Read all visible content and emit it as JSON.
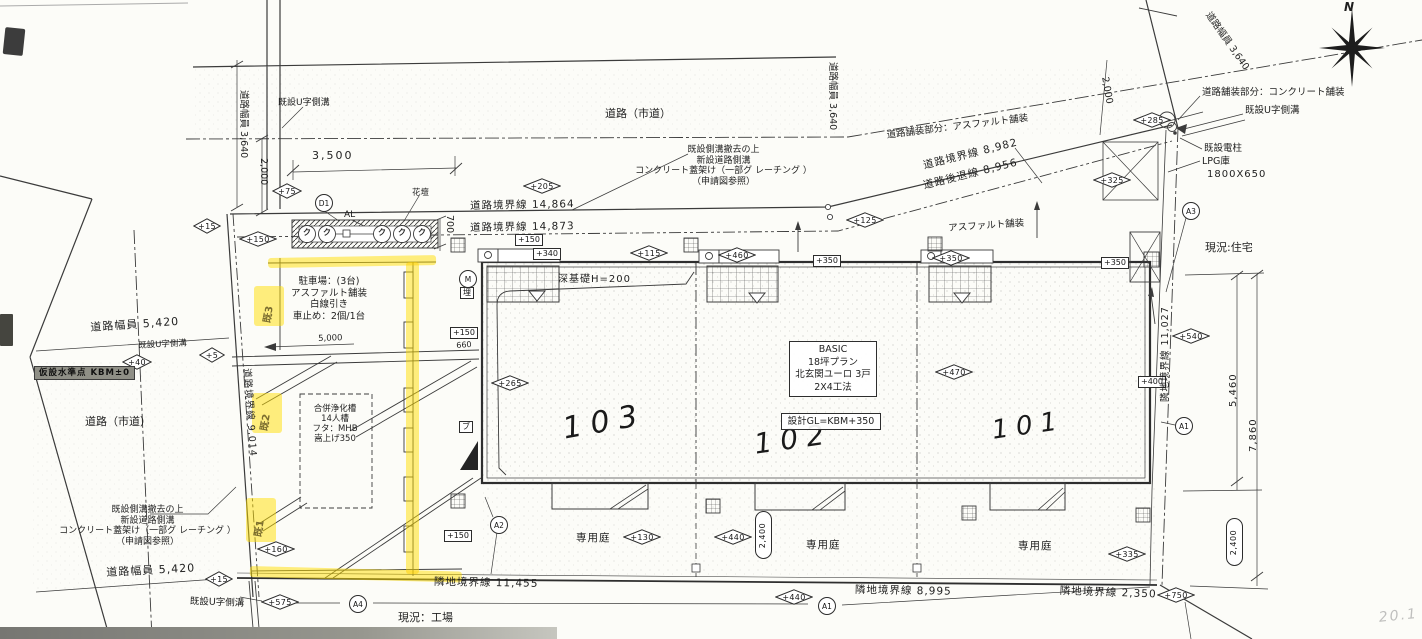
{
  "ink_color": "#3b3b3b",
  "highlight_color": "#ffdd00",
  "compass": {
    "label": "N"
  },
  "labels": [
    {
      "n": "road-city-top-label",
      "t": "道路（市道）",
      "x": 605,
      "y": 108,
      "fs": 11
    },
    {
      "n": "road-city-left-label",
      "t": "道路（市道）",
      "x": 85,
      "y": 416,
      "fs": 11
    },
    {
      "n": "gutter-note-topleft",
      "t": "既設U字側溝",
      "x": 278,
      "y": 98,
      "fs": 9
    },
    {
      "n": "road-width-left",
      "t": "道路幅員 3,640",
      "x": 249,
      "y": 90,
      "fs": 9.5,
      "rot": 90
    },
    {
      "n": "dim-2000-left",
      "t": "2,000",
      "x": 269,
      "y": 158,
      "fs": 9.5,
      "rot": 90
    },
    {
      "n": "dim-3500",
      "t": "3,500",
      "x": 312,
      "y": 150,
      "fs": 11,
      "ls": 2
    },
    {
      "n": "road-boundary-14864",
      "t": "道路境界線 14,864",
      "x": 470,
      "y": 200,
      "fs": 10.5,
      "rot": -1,
      "ls": 1
    },
    {
      "n": "road-boundary-14873",
      "t": "道路境界線 14,873",
      "x": 470,
      "y": 222,
      "fs": 10.5,
      "rot": -1,
      "ls": 1
    },
    {
      "n": "note-sidewalk-top",
      "t": "既設側溝撤去の上\n新設道路側溝\nコンクリート蓋架け（一部グ レーチング ）\n（申請図参照）",
      "x": 626,
      "y": 145,
      "fs": 9,
      "w": 195,
      "ta": "center",
      "lh": 1.18
    },
    {
      "n": "note-pave-asphalt",
      "t": "道路舗装部分：アスファルト舗装",
      "x": 886,
      "y": 130,
      "fs": 9.5,
      "rot": -7
    },
    {
      "n": "road-boundary-8982",
      "t": "道路境界線 8,982",
      "x": 922,
      "y": 160,
      "fs": 10.5,
      "rot": -14,
      "ls": 1
    },
    {
      "n": "road-setback-8956",
      "t": "道路後退線 8,956",
      "x": 922,
      "y": 180,
      "fs": 10.5,
      "rot": -14,
      "ls": 1
    },
    {
      "n": "asphalt-pave-label",
      "t": "アスファルト舗装",
      "x": 948,
      "y": 223,
      "fs": 9.5,
      "rot": -4
    },
    {
      "n": "road-width-mid",
      "t": "道路幅員 3,640",
      "x": 838,
      "y": 62,
      "fs": 9.5,
      "rot": 90
    },
    {
      "n": "dim-2000-right",
      "t": "2,000",
      "x": 1110,
      "y": 76,
      "fs": 9.5,
      "rot": 80
    },
    {
      "n": "road-width-right",
      "t": "道路幅員 3,640",
      "x": 1212,
      "y": 10,
      "fs": 9.5,
      "rot": 55
    },
    {
      "n": "note-pave-concrete",
      "t": "道路舗装部分：コンクリート舗装",
      "x": 1202,
      "y": 87,
      "fs": 9.5
    },
    {
      "n": "gutter-note-topright",
      "t": "既設U字側溝",
      "x": 1245,
      "y": 105,
      "fs": 9.5
    },
    {
      "n": "pole-note",
      "t": "既設電柱",
      "x": 1204,
      "y": 143,
      "fs": 9.5
    },
    {
      "n": "lpg-note",
      "t": "LPG庫",
      "x": 1202,
      "y": 156,
      "fs": 9.5
    },
    {
      "n": "lpg-size",
      "t": "1800X650",
      "x": 1207,
      "y": 169,
      "fs": 10,
      "ls": 1
    },
    {
      "n": "existing-house-label",
      "t": "現況:住宅",
      "x": 1205,
      "y": 242,
      "fs": 11
    },
    {
      "n": "flowerbed-label",
      "t": "花壇",
      "x": 412,
      "y": 188,
      "fs": 8.5
    },
    {
      "n": "al-label",
      "t": "AL",
      "x": 344,
      "y": 210,
      "fs": 9
    },
    {
      "n": "dim-700",
      "t": "700",
      "x": 455,
      "y": 215,
      "fs": 9.5,
      "rot": 90
    },
    {
      "n": "parking-note",
      "t": "駐車場：(3台)\nアスファルト舗装\n白線引き\n車止め：2個/1台",
      "x": 285,
      "y": 276,
      "fs": 9.5,
      "w": 88,
      "ta": "center",
      "lh": 1.22
    },
    {
      "n": "dim-5000",
      "t": "5,000",
      "x": 318,
      "y": 334,
      "fs": 8.5,
      "rot": -2
    },
    {
      "n": "septic-note",
      "t": "合併浄化槽\n14人槽\nフタ：MHB\n嵩上げ350",
      "x": 303,
      "y": 404,
      "fs": 8.5,
      "w": 64,
      "ta": "center",
      "lh": 1.18
    },
    {
      "n": "kbm-benchmark",
      "t": "仮設水準点 KBM±0",
      "x": 34,
      "y": 366,
      "fs": 8.5,
      "cls": "kbm"
    },
    {
      "n": "road-boundary-9014",
      "t": "道路境界線 9,014",
      "x": 252,
      "y": 368,
      "fs": 9.5,
      "rot": 86,
      "ls": 1
    },
    {
      "n": "road-width-5420-top",
      "t": "道路幅員 5,420",
      "x": 90,
      "y": 322,
      "fs": 11,
      "rot": -4,
      "ls": 1
    },
    {
      "n": "gutter-note-left",
      "t": "既設U字側溝",
      "x": 138,
      "y": 341,
      "fs": 8.5,
      "rot": -3
    },
    {
      "n": "note-sidewalk-left",
      "t": "既設側溝撤去の上\n新設道路側溝\nコンクリート蓋架け（一部グ レーチング ）\n（申請図参照）",
      "x": 55,
      "y": 505,
      "fs": 9,
      "w": 185,
      "ta": "center",
      "lh": 1.18
    },
    {
      "n": "road-width-5420-bottom",
      "t": "道路幅員 5,420",
      "x": 106,
      "y": 567,
      "fs": 11,
      "rot": -3,
      "ls": 1
    },
    {
      "n": "gutter-note-bottomleft",
      "t": "既設U字側溝",
      "x": 190,
      "y": 596,
      "fs": 9.5,
      "rot": 2
    },
    {
      "n": "existing-factory-label",
      "t": "現況：工場",
      "x": 398,
      "y": 612,
      "fs": 11
    },
    {
      "n": "site-boundary-11455",
      "t": "隣地境界線 11,455",
      "x": 434,
      "y": 576,
      "fs": 10.5,
      "rot": 1,
      "ls": 1
    },
    {
      "n": "site-boundary-8995",
      "t": "隣地境界線 8,995",
      "x": 855,
      "y": 584,
      "fs": 10.5,
      "rot": 1,
      "ls": 1
    },
    {
      "n": "site-boundary-2350",
      "t": "隣地境界線 2,350",
      "x": 1060,
      "y": 585,
      "fs": 10.5,
      "rot": 2,
      "ls": 1
    },
    {
      "n": "site-boundary-11027",
      "t": "隣地境界線 11,027",
      "x": 1160,
      "y": 402,
      "fs": 9.5,
      "rot": -90,
      "ls": 1
    },
    {
      "n": "dim-5460",
      "t": "5,460",
      "x": 1228,
      "y": 407,
      "fs": 10,
      "rot": -90,
      "ls": 1
    },
    {
      "n": "dim-7860",
      "t": "7,860",
      "x": 1248,
      "y": 452,
      "fs": 10,
      "rot": -90,
      "ls": 1
    },
    {
      "n": "deep-foundation-label",
      "t": "深基礎H=200",
      "x": 558,
      "y": 274,
      "fs": 10,
      "ls": 1
    },
    {
      "n": "unit-number-103",
      "t": "103",
      "x": 560,
      "y": 412,
      "fs": 30,
      "rot": -10,
      "cls": "hand"
    },
    {
      "n": "unit-number-102",
      "t": "102",
      "x": 752,
      "y": 428,
      "fs": 28,
      "rot": -8,
      "cls": "hand"
    },
    {
      "n": "unit-number-101",
      "t": "101",
      "x": 990,
      "y": 416,
      "fs": 26,
      "rot": -8,
      "cls": "hand"
    },
    {
      "n": "private-garden-103",
      "t": "専用庭",
      "x": 576,
      "y": 532,
      "fs": 10.5,
      "ls": 1
    },
    {
      "n": "private-garden-102",
      "t": "専用庭",
      "x": 806,
      "y": 539,
      "fs": 10.5,
      "ls": 1
    },
    {
      "n": "private-garden-101",
      "t": "専用庭",
      "x": 1018,
      "y": 540,
      "fs": 10.5,
      "ls": 1
    },
    {
      "n": "dim-660",
      "t": "660",
      "x": 456,
      "y": 341,
      "fs": 8,
      "rot": -4
    },
    {
      "n": "compass-north-label",
      "t": "N",
      "x": 1344,
      "y": 0,
      "fs": 12,
      "cls": "hand2"
    },
    {
      "n": "pencil-mark",
      "t": "20.1",
      "x": 1378,
      "y": 610,
      "fs": 14,
      "rot": -6,
      "cls": "pencil"
    },
    {
      "n": "highlight-mark-3",
      "t": "既3",
      "x": 262,
      "y": 322,
      "fs": 10,
      "rot": -80,
      "cls": "handmark"
    },
    {
      "n": "highlight-mark-2",
      "t": "既2",
      "x": 259,
      "y": 430,
      "fs": 10,
      "rot": -80,
      "cls": "handmark"
    },
    {
      "n": "highlight-mark-1",
      "t": "既1",
      "x": 253,
      "y": 536,
      "fs": 10,
      "rot": -80,
      "cls": "handmark"
    },
    {
      "n": "plant-symbol",
      "t": "ク",
      "x": 303,
      "y": 228,
      "fs": 8,
      "cls": "plant"
    },
    {
      "n": "plant-symbol",
      "t": "ク",
      "x": 323,
      "y": 228,
      "fs": 8,
      "cls": "plant"
    },
    {
      "n": "plant-symbol",
      "t": "ク",
      "x": 378,
      "y": 228,
      "fs": 8,
      "cls": "plant"
    },
    {
      "n": "plant-symbol",
      "t": "ク",
      "x": 398,
      "y": 228,
      "fs": 8,
      "cls": "plant"
    },
    {
      "n": "plant-symbol",
      "t": "ク",
      "x": 418,
      "y": 228,
      "fs": 8,
      "cls": "plant"
    },
    {
      "n": "building-spec-box",
      "t": "BASIC\n18坪プラン\n北玄関ユーロ 3戸\n2X4工法",
      "x": 789,
      "y": 341,
      "fs": 9.5,
      "w": 80,
      "ta": "center",
      "lh": 1.32,
      "cls": "boxed"
    },
    {
      "n": "design-gl-box",
      "t": "設計GL=KBM+350",
      "x": 781,
      "y": 413,
      "fs": 9.5,
      "w": 92,
      "ta": "center",
      "cls": "boxed"
    }
  ],
  "markers": [
    {
      "n": "elev-205",
      "s": "d",
      "t": "+205",
      "cx": 542,
      "cy": 186
    },
    {
      "n": "elev-75",
      "s": "d",
      "t": "+75",
      "cx": 287,
      "cy": 191,
      "w": 30
    },
    {
      "n": "elev-15-flowerbed",
      "s": "d",
      "t": "+15",
      "cx": 207,
      "cy": 226,
      "w": 28
    },
    {
      "n": "elev-150-flowerbed",
      "s": "d",
      "t": "+150",
      "cx": 258,
      "cy": 239
    },
    {
      "n": "elev-115",
      "s": "d",
      "t": "+115",
      "cx": 649,
      "cy": 253
    },
    {
      "n": "elev-460",
      "s": "d",
      "t": "+460",
      "cx": 737,
      "cy": 255
    },
    {
      "n": "elev-350-mid",
      "s": "d",
      "t": "+350",
      "cx": 951,
      "cy": 258
    },
    {
      "n": "elev-265",
      "s": "d",
      "t": "+265",
      "cx": 510,
      "cy": 383
    },
    {
      "n": "elev-470",
      "s": "d",
      "t": "+470",
      "cx": 954,
      "cy": 372
    },
    {
      "n": "elev-325",
      "s": "d",
      "t": "+325",
      "cx": 1112,
      "cy": 180
    },
    {
      "n": "elev-285",
      "s": "d",
      "t": "+285",
      "cx": 1152,
      "cy": 120
    },
    {
      "n": "elev-125",
      "s": "d",
      "t": "+125",
      "cx": 865,
      "cy": 220
    },
    {
      "n": "elev-540",
      "s": "d",
      "t": "+540",
      "cx": 1191,
      "cy": 336
    },
    {
      "n": "elev-40",
      "s": "d",
      "t": "+40",
      "cx": 137,
      "cy": 362,
      "w": 30
    },
    {
      "n": "elev-5",
      "s": "d",
      "t": "+5",
      "cx": 212,
      "cy": 355,
      "w": 26
    },
    {
      "n": "elev-160",
      "s": "d",
      "t": "+160",
      "cx": 276,
      "cy": 549
    },
    {
      "n": "elev-15-bottom",
      "s": "d",
      "t": "+15",
      "cx": 219,
      "cy": 579,
      "w": 28
    },
    {
      "n": "elev-575",
      "s": "d",
      "t": "+575",
      "cx": 280,
      "cy": 602
    },
    {
      "n": "elev-130",
      "s": "d",
      "t": "+130",
      "cx": 642,
      "cy": 537
    },
    {
      "n": "elev-440-garden",
      "s": "d",
      "t": "+440",
      "cx": 733,
      "cy": 537
    },
    {
      "n": "elev-440-bottom",
      "s": "d",
      "t": "+440",
      "cx": 794,
      "cy": 597
    },
    {
      "n": "elev-335",
      "s": "d",
      "t": "+335",
      "cx": 1127,
      "cy": 554
    },
    {
      "n": "elev-750",
      "s": "d",
      "t": "+750",
      "cx": 1176,
      "cy": 595
    },
    {
      "n": "spot-150-porch",
      "s": "b",
      "t": "+150",
      "cx": 529,
      "cy": 240
    },
    {
      "n": "spot-340-porch",
      "s": "b",
      "t": "+340",
      "cx": 547,
      "cy": 254
    },
    {
      "n": "spot-350-mid",
      "s": "b",
      "t": "+350",
      "cx": 827,
      "cy": 261
    },
    {
      "n": "spot-350-right",
      "s": "b",
      "t": "+350",
      "cx": 1115,
      "cy": 263
    },
    {
      "n": "spot-150-gate",
      "s": "b",
      "t": "+150",
      "cx": 464,
      "cy": 333
    },
    {
      "n": "spot-150-south",
      "s": "b",
      "t": "+150",
      "cx": 458,
      "cy": 536
    },
    {
      "n": "spot-400-right",
      "s": "b",
      "t": "+400",
      "cx": 1152,
      "cy": 382
    },
    {
      "n": "buried-utility-marker",
      "s": "b",
      "t": "埋",
      "cx": 467,
      "cy": 293
    },
    {
      "n": "bu-marker",
      "s": "b",
      "t": "ブ",
      "cx": 466,
      "cy": 427
    },
    {
      "n": "detail-marker-d1",
      "s": "c",
      "t": "D1",
      "cx": 323,
      "cy": 202
    },
    {
      "n": "meter-marker-m",
      "s": "c",
      "t": "M",
      "cx": 467,
      "cy": 278
    },
    {
      "n": "section-marker-a2",
      "s": "c",
      "t": "A2",
      "cx": 498,
      "cy": 524
    },
    {
      "n": "section-marker-a4",
      "s": "c",
      "t": "A4",
      "cx": 357,
      "cy": 603
    },
    {
      "n": "section-marker-a1-bottom",
      "s": "c",
      "t": "A1",
      "cx": 826,
      "cy": 605
    },
    {
      "n": "section-marker-a1-right",
      "s": "c",
      "t": "A1",
      "cx": 1183,
      "cy": 425
    },
    {
      "n": "section-marker-a3",
      "s": "c",
      "t": "A3",
      "cx": 1190,
      "cy": 210
    },
    {
      "n": "dim-capsule-2400-garden",
      "s": "o",
      "t": "2,400",
      "cx": 762,
      "cy": 534
    },
    {
      "n": "dim-capsule-2400-right",
      "s": "o",
      "t": "2,400",
      "cx": 1233,
      "cy": 541
    }
  ],
  "highlights": [
    {
      "n": "highlighter-line-top",
      "x": 268,
      "y": 258,
      "w": 168,
      "h": 10,
      "rot": -1
    },
    {
      "n": "highlighter-line-vertical",
      "x": 406,
      "y": 262,
      "w": 13,
      "h": 312
    },
    {
      "n": "highlighter-line-bottom",
      "x": 250,
      "y": 566,
      "w": 212,
      "h": 11,
      "rot": 1.5
    },
    {
      "n": "highlighter-patch-3",
      "x": 254,
      "y": 286,
      "w": 30,
      "h": 40
    },
    {
      "n": "highlighter-patch-2",
      "x": 252,
      "y": 393,
      "w": 30,
      "h": 40
    },
    {
      "n": "highlighter-patch-1",
      "x": 246,
      "y": 498,
      "w": 30,
      "h": 44
    }
  ]
}
